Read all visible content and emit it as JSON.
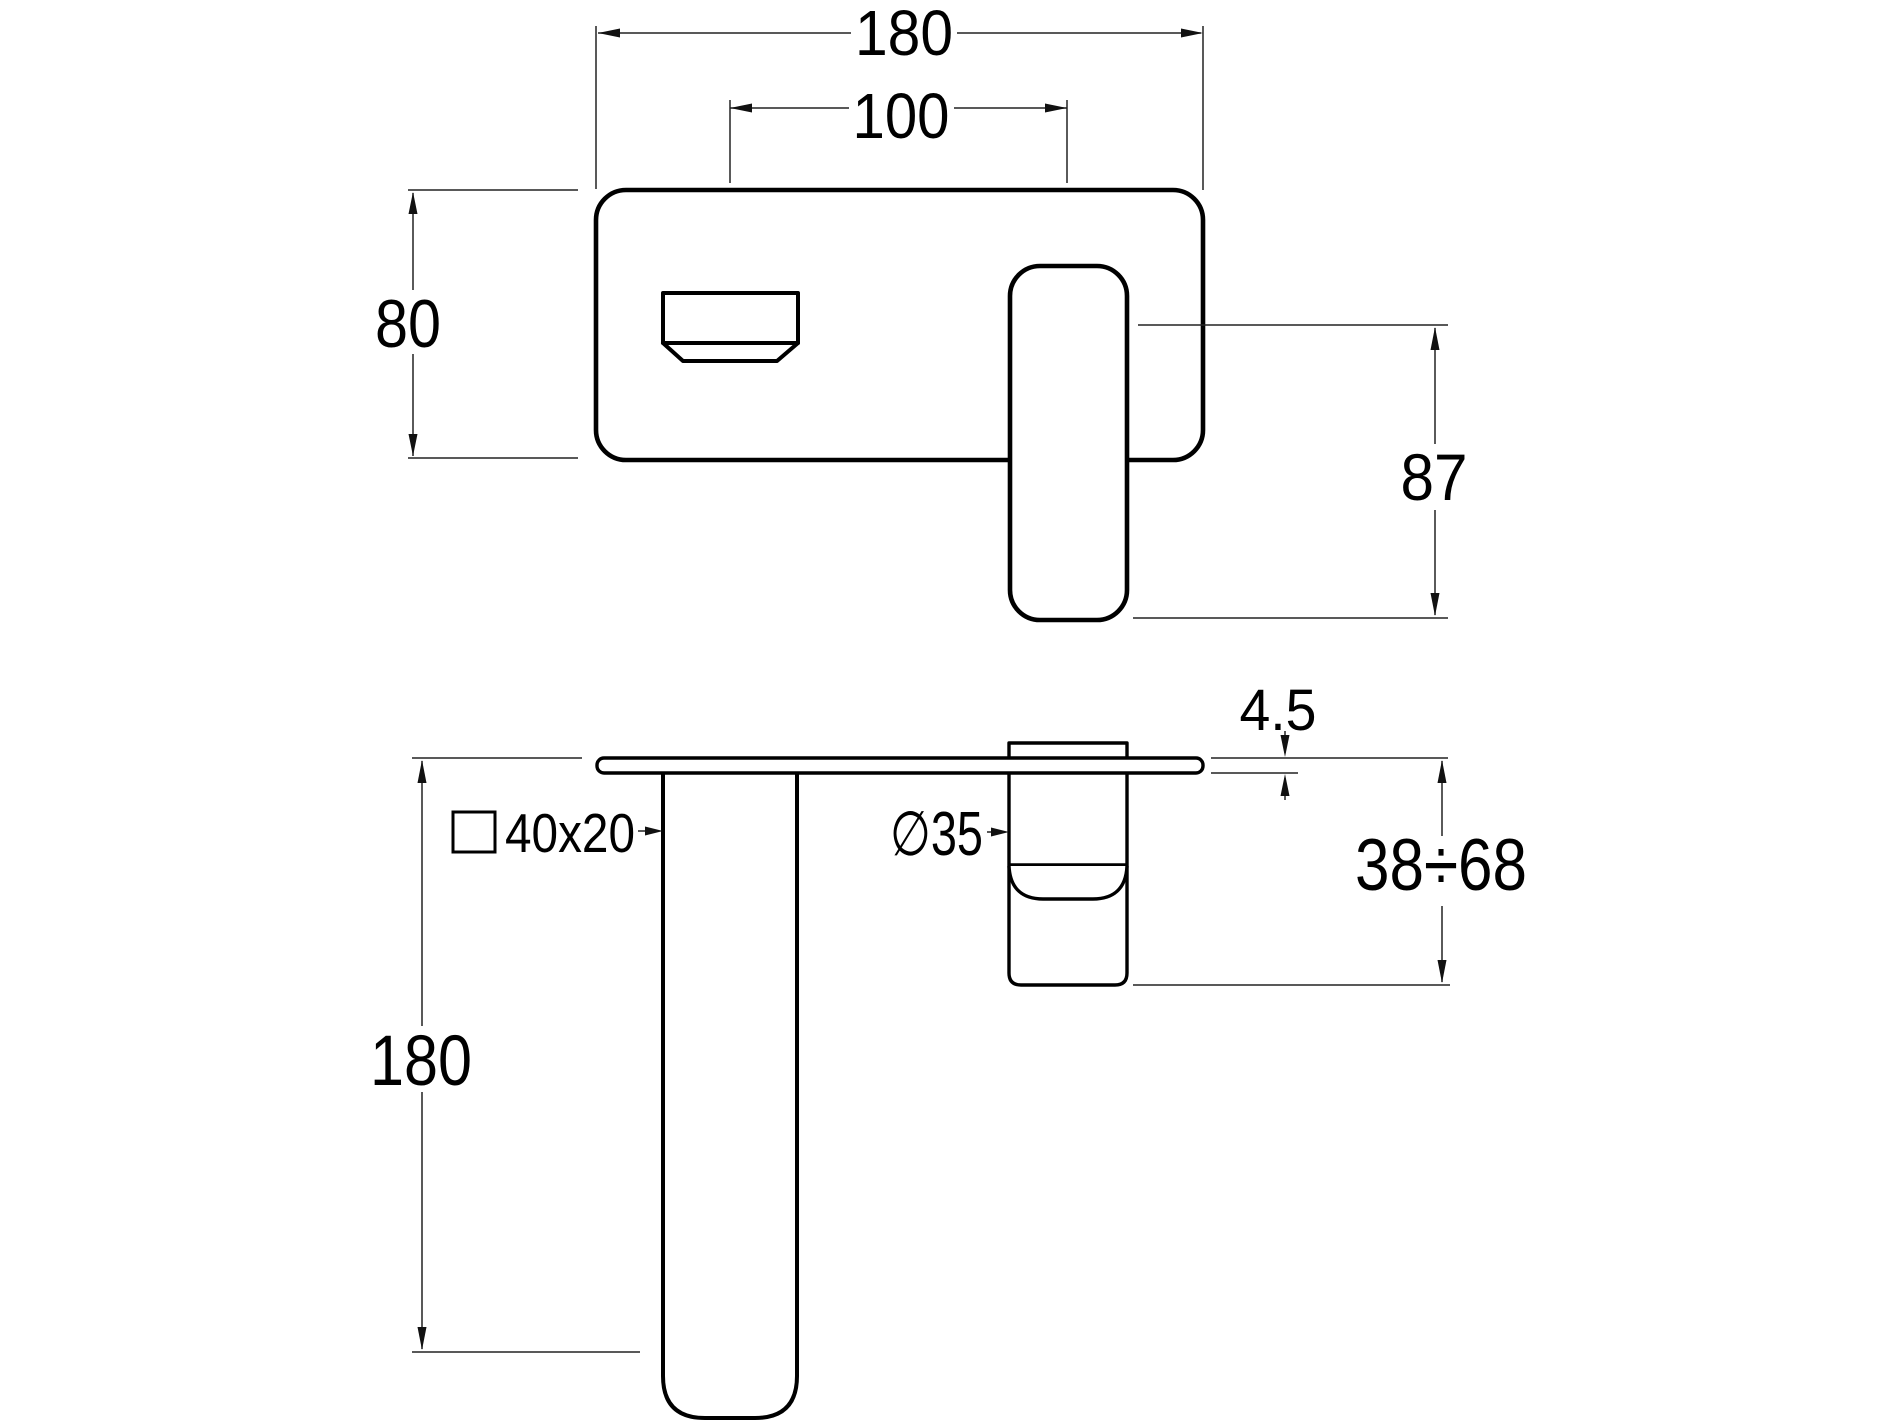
{
  "drawing": {
    "title": "wall-mounted basin mixer dimension drawing",
    "background_color": "#ffffff",
    "outline_color": "#000000",
    "dimension_line_color": "#222222",
    "labels": {
      "plate_width": "180",
      "centers": "100",
      "plate_height": "80",
      "lever_height": "87",
      "plate_thickness": "4.5",
      "recess_depth": "38÷68",
      "spout_reach": "180",
      "spout_section": "40x20",
      "cartridge_diameter": "∅35"
    }
  }
}
